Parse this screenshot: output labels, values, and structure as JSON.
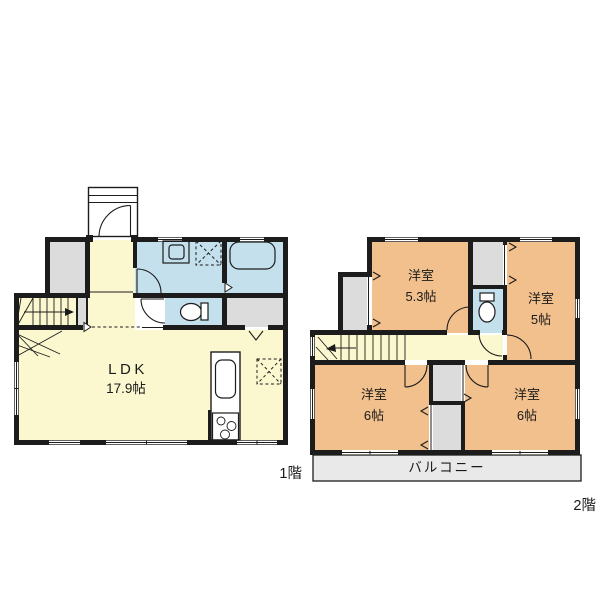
{
  "floor1": {
    "label": "1階",
    "ldk": {
      "name": "LDK",
      "size": "17.9帖"
    }
  },
  "floor2": {
    "label": "2階",
    "rooms": [
      {
        "name": "洋室",
        "size": "5.3帖"
      },
      {
        "name": "洋室",
        "size": "5帖"
      },
      {
        "name": "洋室",
        "size": "6帖"
      },
      {
        "name": "洋室",
        "size": "6帖"
      }
    ],
    "balcony_label": "バルコニー"
  },
  "colors": {
    "wall": "#1c1c1c",
    "yellow": "#fbf8d0",
    "orange": "#f2c08c",
    "blue": "#c3e0ec",
    "gray": "#dcdcdc",
    "balcony": "#e9e9e9",
    "paper": "#ffffff",
    "text": "#1a1a1a"
  }
}
